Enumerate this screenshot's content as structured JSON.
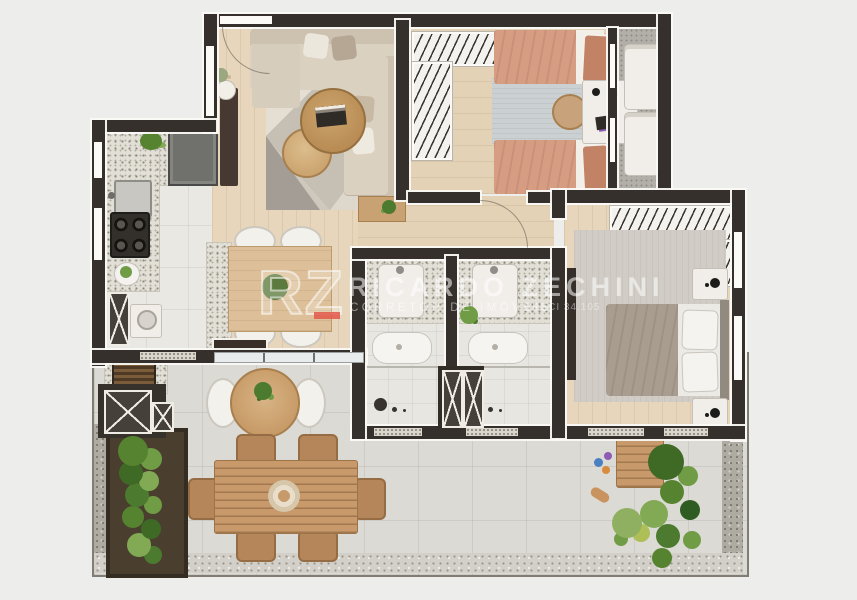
{
  "watermark": {
    "logo_text": "RZ",
    "name": "RICARDO ZECHINI",
    "subtitle": "CORRETOR DE IMÓVEIS",
    "license": "CRECI 34.105"
  },
  "palette": {
    "background": "#edeeec",
    "wall": "#35302b",
    "wood_floor": "#e7d6bb",
    "tile_floor": "#eae8e3",
    "balcony_tile": "#dcdad4",
    "gravel": "#aeaba3",
    "terrazzo_counter": "#e2dfd7",
    "sofa": "#d9cfbf",
    "twin_bed_duvet": "#d79d82",
    "master_bed_duvet": "#a99d90",
    "outdoor_wood": "#c89a6b",
    "plant_green": "#55832f",
    "accent_red": "#e2574a",
    "watermark_text": "rgba(255,255,255,0.55)"
  }
}
